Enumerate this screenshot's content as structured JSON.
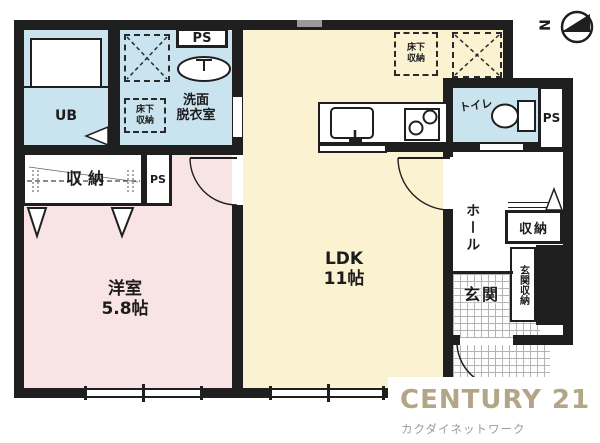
{
  "floorplan": {
    "compass": {
      "label": "N"
    },
    "rooms": {
      "ub": {
        "label": "UB"
      },
      "washroom": {
        "line1": "洗面",
        "line2": "脱衣室"
      },
      "western_room": {
        "name": "洋室",
        "size": "5.8帖"
      },
      "ldk": {
        "name": "LDK",
        "size": "11帖"
      },
      "toilet": {
        "label": "トイレ"
      },
      "hall": {
        "label": "ホール"
      },
      "genkan": {
        "label": "玄関"
      }
    },
    "storage": {
      "underfloor_wash": {
        "line1": "床下",
        "line2": "収納"
      },
      "underfloor_ldk": {
        "line1": "床下",
        "line2": "収納"
      },
      "closet_left": "収納",
      "closet_hall": "収納",
      "genkan_storage": "玄関収納"
    },
    "shafts": {
      "ps_wash": "PS",
      "ps_closet": "PS",
      "ps_right": "PS"
    }
  },
  "branding": {
    "brand": "CENTURY 21",
    "company": "カクダイネットワーク",
    "brand_color": "#b3a688",
    "company_color": "#9b9b9b"
  }
}
